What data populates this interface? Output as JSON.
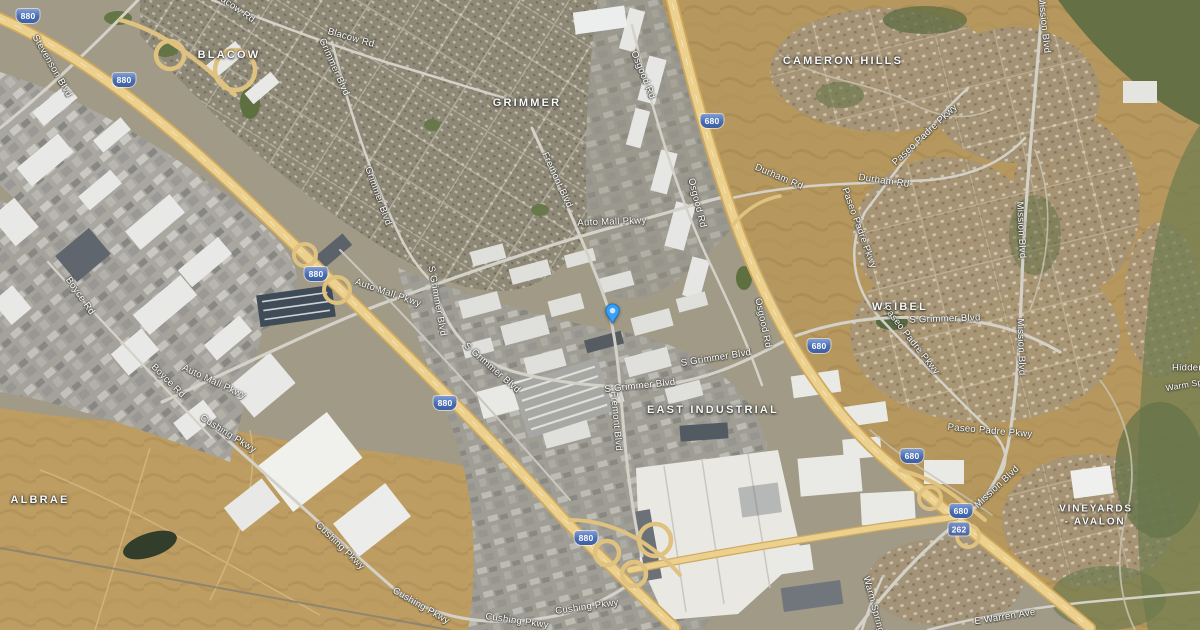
{
  "map": {
    "view_mode": "satellite",
    "marker": {
      "type": "place-pin",
      "color_outer": "#38a0f4",
      "color_inner": "#cde7fc"
    },
    "palette": {
      "freeway": "#ecd08d",
      "dry_hills": "#b6985e",
      "urban": "#a19a86",
      "vegetation": "#5e6e43",
      "shield_blue": "#4a6cb0"
    },
    "neighborhoods": [
      {
        "text": "BLACOW"
      },
      {
        "text": "GRIMMER"
      },
      {
        "text": "CAMERON HILLS"
      },
      {
        "text": "WEIBEL"
      },
      {
        "text": "EAST INDUSTRIAL"
      },
      {
        "text": "ALBRAE"
      },
      {
        "text": "VINEYARDS"
      },
      {
        "text": "- AVALON"
      }
    ],
    "roads": [
      {
        "text": "Stevenson Blvd"
      },
      {
        "text": "Blacow Rd"
      },
      {
        "text": "Blacow Rd"
      },
      {
        "text": "Grimmer Blvd"
      },
      {
        "text": "Grimmer Blvd"
      },
      {
        "text": "Auto Mall Pkwy"
      },
      {
        "text": "Auto Mall Pkwy"
      },
      {
        "text": "Auto Mall Pkwy"
      },
      {
        "text": "Fremont Blvd"
      },
      {
        "text": "Fremont Blvd"
      },
      {
        "text": "Osgood Rd"
      },
      {
        "text": "Osgood Rd"
      },
      {
        "text": "Osgood Rd"
      },
      {
        "text": "Durham Rd"
      },
      {
        "text": "Durham Rd"
      },
      {
        "text": "Mission Blvd"
      },
      {
        "text": "Mission Blvd"
      },
      {
        "text": "Mission Blvd"
      },
      {
        "text": "Mission Blvd"
      },
      {
        "text": "Paseo Padre Pkwy"
      },
      {
        "text": "Paseo Padre Pkwy"
      },
      {
        "text": "Paseo Padre Pkwy"
      },
      {
        "text": "Paseo Padre Pkwy"
      },
      {
        "text": "Boyce Rd"
      },
      {
        "text": "Boyce Rd"
      },
      {
        "text": "Cushing Pkwy"
      },
      {
        "text": "Cushing Pkwy"
      },
      {
        "text": "Cushing Pkwy"
      },
      {
        "text": "Cushing Pkwy"
      },
      {
        "text": "Cushing Pkwy"
      },
      {
        "text": "S Grimmer Blvd"
      },
      {
        "text": "S Grimmer Blvd"
      },
      {
        "text": "S Grimmer Blvd"
      },
      {
        "text": "S Grimmer Blvd"
      },
      {
        "text": "S Grimmer Blvd"
      },
      {
        "text": "E Warren Ave"
      },
      {
        "text": "Warm Springs Blvd"
      },
      {
        "text": "Hidden"
      },
      {
        "text": "Warm Sp"
      }
    ],
    "shields": [
      {
        "route": "interstate",
        "text": "880"
      },
      {
        "route": "interstate",
        "text": "880"
      },
      {
        "route": "interstate",
        "text": "880"
      },
      {
        "route": "interstate",
        "text": "880"
      },
      {
        "route": "interstate",
        "text": "880"
      },
      {
        "route": "interstate",
        "text": "680"
      },
      {
        "route": "interstate",
        "text": "680"
      },
      {
        "route": "interstate",
        "text": "680"
      },
      {
        "route": "interstate",
        "text": "680"
      },
      {
        "route": "state",
        "text": "262"
      }
    ]
  }
}
